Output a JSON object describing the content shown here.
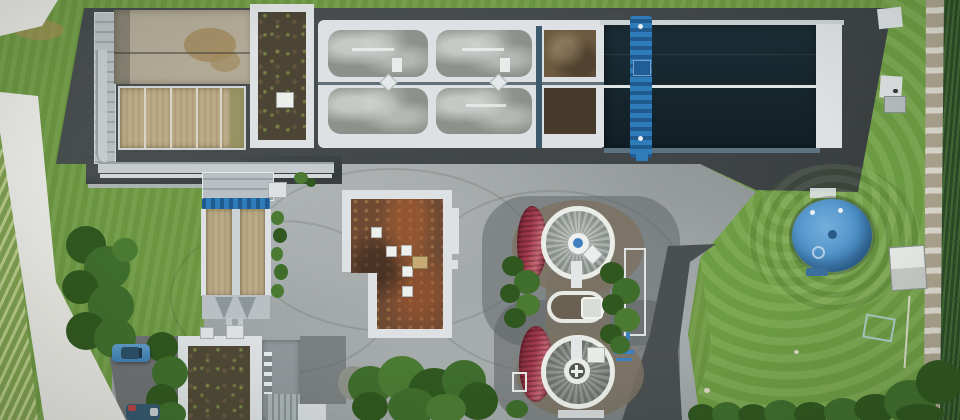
{
  "scene": {
    "type": "aerial-photograph",
    "subject": "wastewater-treatment-plant",
    "orientation": "top-down drone view, daylight"
  },
  "palette": {
    "grass": "#6e9a43",
    "lawn_right": "#74a348",
    "crop_rows_light": "#b7c987",
    "crop_rows_dark": "#7f9e50",
    "field_dark": "#2c4a27",
    "road_light": "#e4e4df",
    "gravel_path": "#b3ab97",
    "asphalt_dark": "#3e4345",
    "asphalt_mid": "#5c6163",
    "asphalt_curve": "#4a4f51",
    "carpark": "#6e7173",
    "yard_concrete": "#9aa0a1",
    "white_structure": "#dde1e3",
    "concrete_walkway": "#b9c0c3",
    "basin_gray": "#8e918b",
    "basin_tan": "#bcab87",
    "basin_concrete": "#b2aa96",
    "wet_patch": "#a08a5e",
    "dark_water": "#16262e",
    "sludge_brown": "#6d5a41",
    "sludge_dark": "#463a2b",
    "crane_blue": "#2f7cbb",
    "tank_blue": "#4b8fc7",
    "tank_blue_light": "#74aedb",
    "tank_red": "#a13a4c",
    "tank_red_dark": "#7c2a38",
    "roof_gravel_dark": "#4c4434",
    "roof_rust": "#6e4a33",
    "tree_green": "#3f6d2c",
    "tree_green_dark": "#30571f",
    "bush_green": "#4b7a33",
    "dirt_ring": "#7b7263",
    "car_blue": "#4584b4"
  },
  "features": [
    {
      "name": "aeration-basin-block",
      "description": "six rounded rectangular aeration cells in a white concrete frame, gray water with white foam streaks, central catwalk"
    },
    {
      "name": "secondary-basin-dark",
      "description": "long dark teal water basin with white center lane line, white end wall and blue traveling crane bridge"
    },
    {
      "name": "headworks-building",
      "description": "top-left unit with concrete basin, tan settling tanks and gravel-roof annex with skylight"
    },
    {
      "name": "longitudinal-clarifiers",
      "description": "two long tan clarifier lanes with central walkway, blue hoist bridge and twin discharge cones"
    },
    {
      "name": "operations-building",
      "description": "L-shaped building with white tiled parapet, rust-brown gravel roof and square skylights"
    },
    {
      "name": "circular-clarifiers",
      "description": "two circular clarifiers with white ring walls, radially streaked gray water, center hubs, connected by a gravel-topped link structure"
    },
    {
      "name": "red-digester-tanks",
      "description": "two ribbed crimson cylindrical tanks beside the circular clarifiers"
    },
    {
      "name": "blue-storage-tank",
      "description": "round blue tank on lawn surrounded by concentric mowing rings, small utility shed nearby"
    },
    {
      "name": "sludge-building",
      "description": "bottom-left building with green gravel roof, gray annex and ribbed metal roof section"
    },
    {
      "name": "site-grounds",
      "description": "asphalt aprons, light concrete service yard with tire marks, access road, vineyard rows, gravel path and crop field at edges, trees, hedges and parked cars"
    }
  ]
}
